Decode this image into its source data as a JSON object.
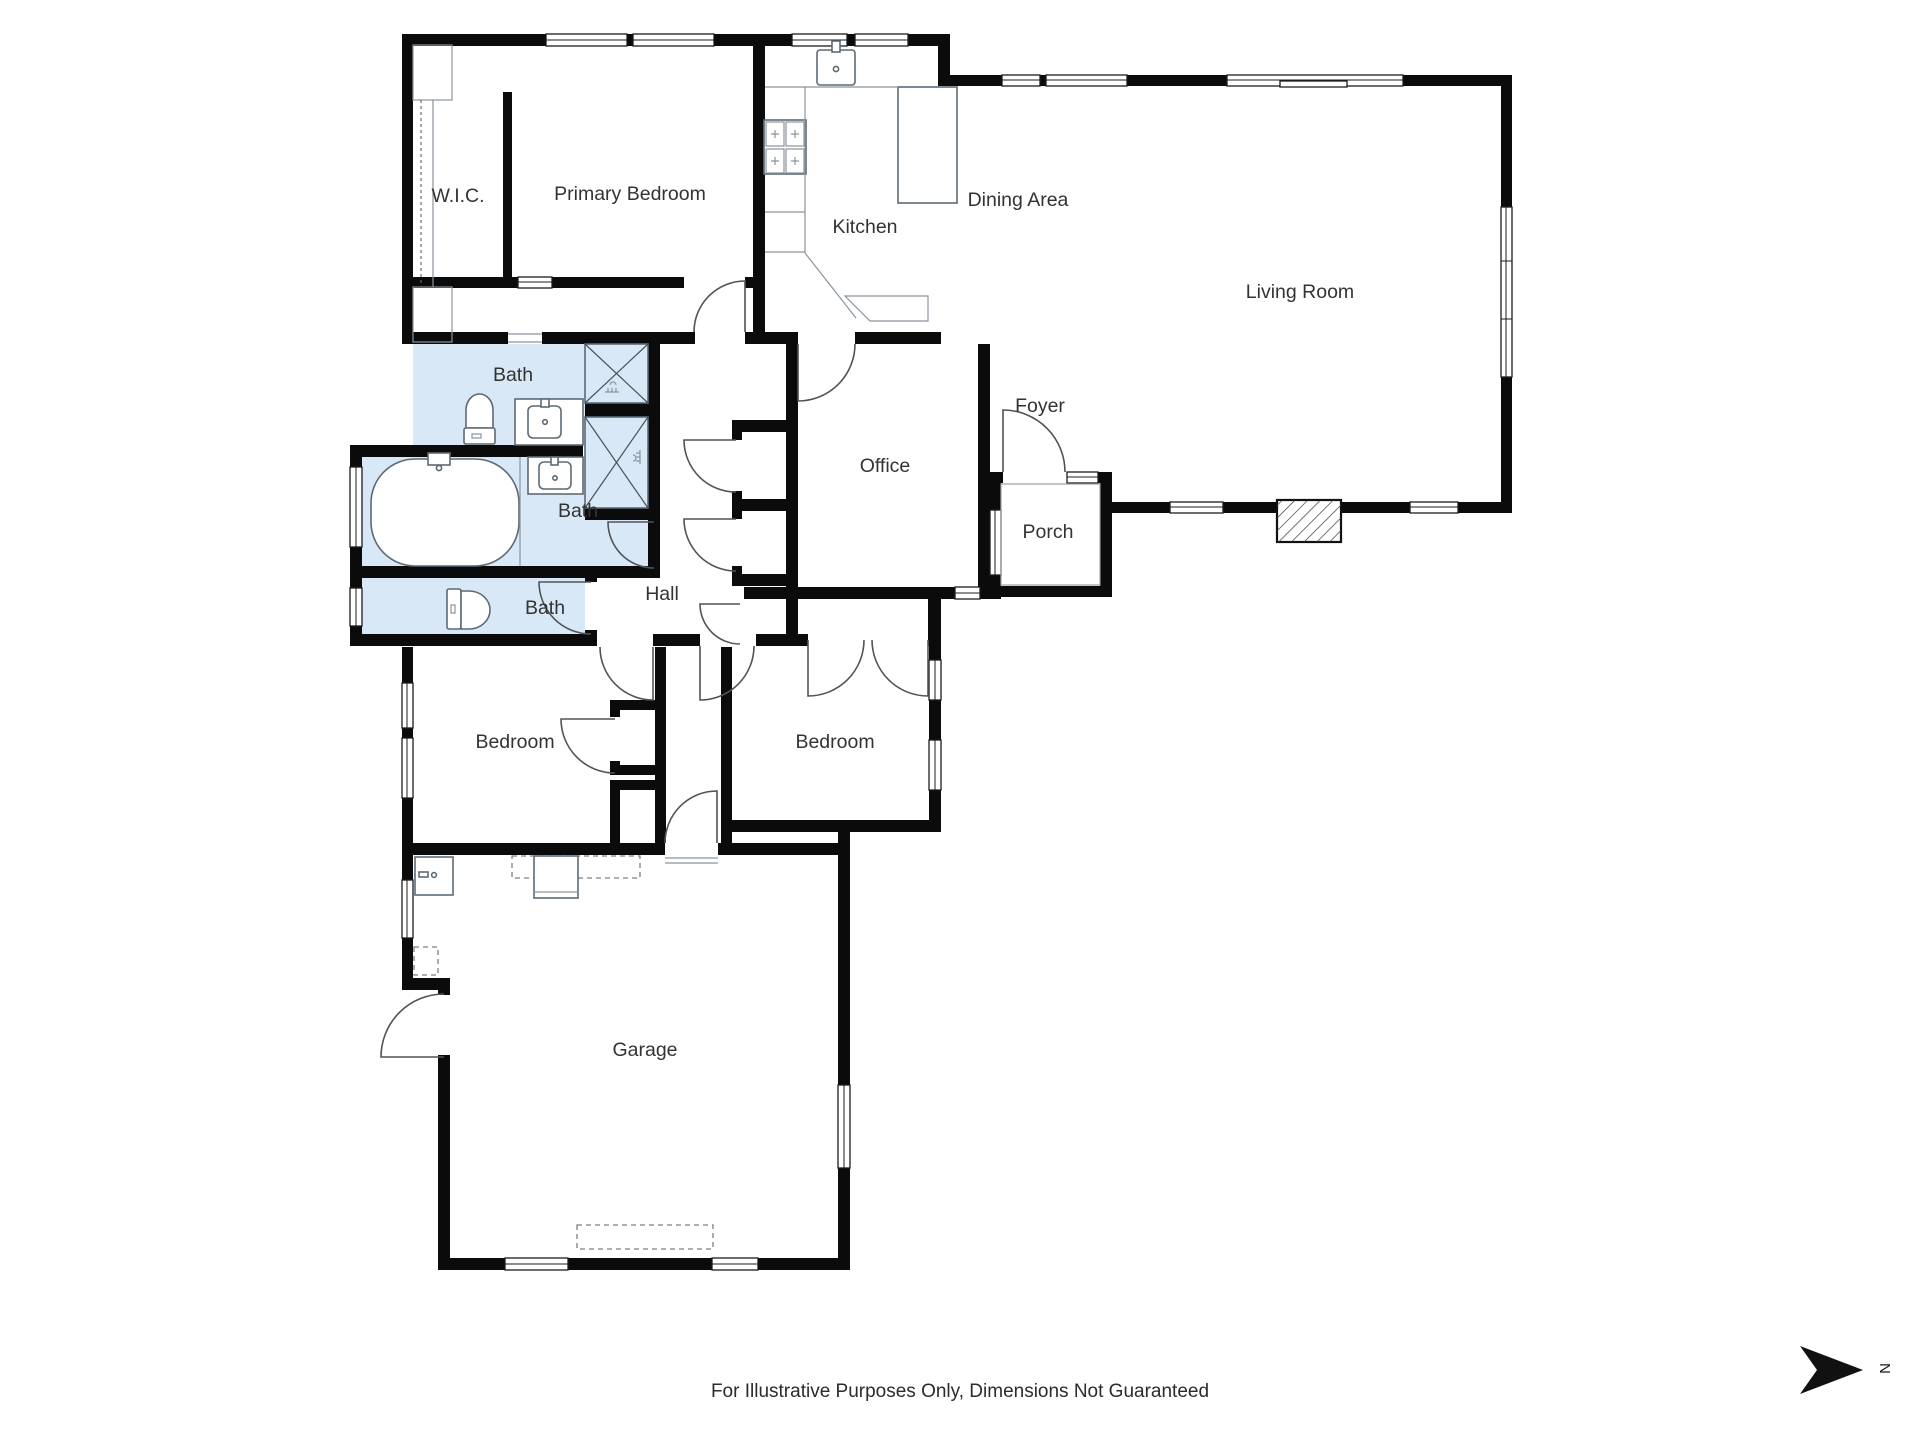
{
  "rooms": [
    {
      "id": "wic",
      "label": "W.I.C."
    },
    {
      "id": "primary_bedroom",
      "label": "Primary Bedroom"
    },
    {
      "id": "kitchen",
      "label": "Kitchen"
    },
    {
      "id": "dining_area",
      "label": "Dining Area"
    },
    {
      "id": "living_room",
      "label": "Living Room"
    },
    {
      "id": "bath_primary",
      "label": "Bath"
    },
    {
      "id": "bath_main",
      "label": "Bath"
    },
    {
      "id": "bath_half",
      "label": "Bath"
    },
    {
      "id": "office",
      "label": "Office"
    },
    {
      "id": "foyer",
      "label": "Foyer"
    },
    {
      "id": "porch",
      "label": "Porch"
    },
    {
      "id": "hall",
      "label": "Hall"
    },
    {
      "id": "bedroom_left",
      "label": "Bedroom"
    },
    {
      "id": "bedroom_right",
      "label": "Bedroom"
    },
    {
      "id": "garage",
      "label": "Garage"
    }
  ],
  "footer": {
    "disclaimer": "For Illustrative Purposes Only, Dimensions Not Guaranteed"
  },
  "compass": {
    "letter": "N"
  },
  "colors": {
    "wall": "#0b0b0b",
    "bath_fill": "#d9e8f6",
    "fixture_stroke": "#5d6a74",
    "door_stroke": "#4f5459",
    "label_text": "#333333"
  }
}
